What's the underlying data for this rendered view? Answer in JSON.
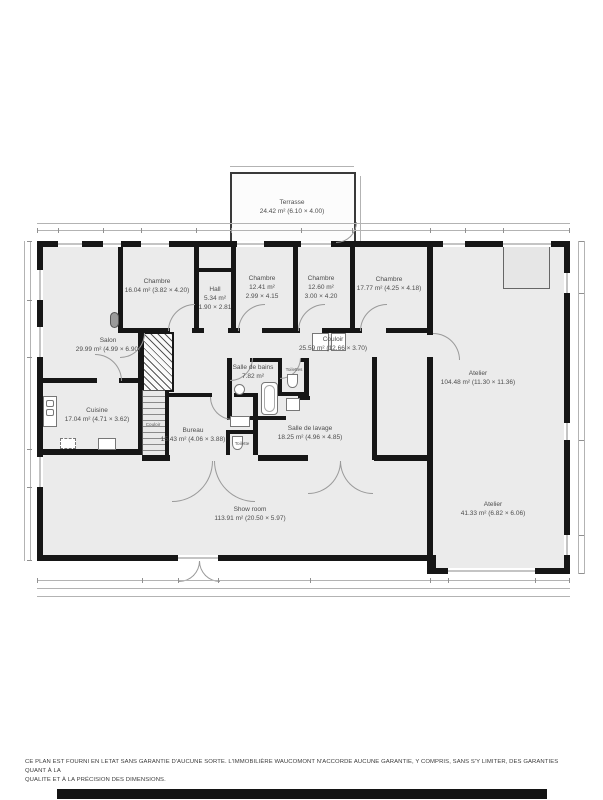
{
  "plan": {
    "rooms": [
      {
        "id": "terrasse",
        "name": "Terrasse",
        "dims": "24.42 m² (6.10 × 4.00)"
      },
      {
        "id": "chambre-1",
        "name": "Chambre",
        "dims": "16.04 m² (3.82 × 4.20)"
      },
      {
        "id": "hall",
        "name": "Hall",
        "dims": "5.34 m²",
        "dims2": "1.90 × 2.81"
      },
      {
        "id": "chambre-2",
        "name": "Chambre",
        "dims": "12.41 m²",
        "dims2": "2.99 × 4.15"
      },
      {
        "id": "chambre-3",
        "name": "Chambre",
        "dims": "12.60 m²",
        "dims2": "3.00 × 4.20"
      },
      {
        "id": "chambre-4",
        "name": "Chambre",
        "dims": "17.77 m² (4.25 × 4.18)"
      },
      {
        "id": "salon",
        "name": "Salon",
        "dims": "29.99 m² (4.99 × 6.90)"
      },
      {
        "id": "couloir",
        "name": "Couloir",
        "dims": "25.59 m² (12.66 × 3.70)"
      },
      {
        "id": "salle-de-bains",
        "name": "Salle de bains",
        "dims": "7.82 m²"
      },
      {
        "id": "toilettes",
        "name": "Toilettes"
      },
      {
        "id": "cuisine",
        "name": "Cuisine",
        "dims": "17.04 m² (4.71 × 3.62)"
      },
      {
        "id": "bureau",
        "name": "Bureau",
        "dims": "15.43 m² (4.06 × 3.88)"
      },
      {
        "id": "toilette",
        "name": "Toilette"
      },
      {
        "id": "couloir-escalier",
        "name": "Couloir"
      },
      {
        "id": "salle-de-lavage",
        "name": "Salle de lavage",
        "dims": "18.25 m² (4.96 × 4.85)"
      },
      {
        "id": "atelier-1",
        "name": "Atelier",
        "dims": "104.48 m² (11.30 × 11.36)"
      },
      {
        "id": "show-room",
        "name": "Show room",
        "dims": "113.91 m² (20.50 × 5.97)"
      },
      {
        "id": "atelier-2",
        "name": "Atelier",
        "dims": "41.33 m² (6.82 × 6.06)"
      }
    ],
    "colors": {
      "wall": "#161616",
      "room_fill": "#ebebeb",
      "terrace_fill": "#fcfcfc",
      "dimension_line": "#b3b3b3",
      "label_text": "#4d4d4d",
      "footer_bar": "#141414"
    }
  },
  "disclaimer": {
    "line1": "CE PLAN EST FOURNI EN LETAT SANS GARANTIE D'AUCUNE SORTE. L'IMMOBILIÈRE WAUCOMONT N'ACCORDE AUCUNE GARANTIE, Y COMPRIS, SANS S'Y LIMITER, DES GARANTIES QUANT À LA",
    "line2": "QUALITE ET À LA PRÉCISION DES DIMENSIONS."
  }
}
